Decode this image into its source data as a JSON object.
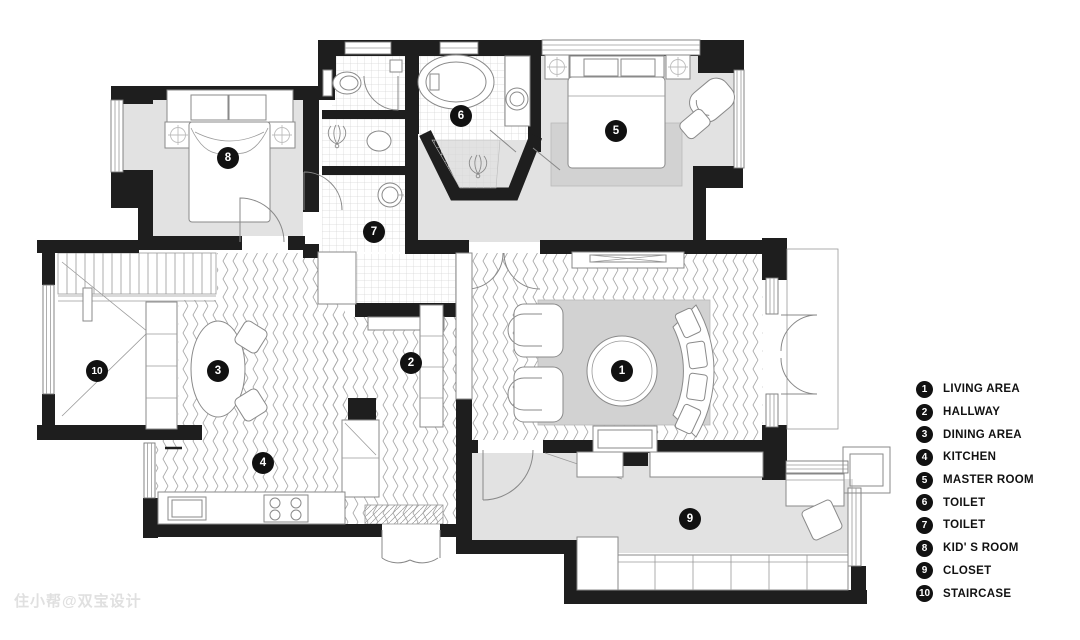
{
  "watermark": {
    "text": "住小帮@双宝设计"
  },
  "legend": {
    "items": [
      {
        "number": "1",
        "label": "LIVING AREA"
      },
      {
        "number": "2",
        "label": "HALLWAY"
      },
      {
        "number": "3",
        "label": "DINING AREA"
      },
      {
        "number": "4",
        "label": "KITCHEN"
      },
      {
        "number": "5",
        "label": "MASTER ROOM"
      },
      {
        "number": "6",
        "label": "TOILET"
      },
      {
        "number": "7",
        "label": "TOILET"
      },
      {
        "number": "8",
        "label": "KID' S ROOM"
      },
      {
        "number": "9",
        "label": "CLOSET"
      },
      {
        "number": "10",
        "label": "STAIRCASE"
      }
    ]
  },
  "plan": {
    "badges": [
      {
        "number": "1",
        "room": "living-area",
        "x": 622,
        "y": 371
      },
      {
        "number": "2",
        "room": "hallway",
        "x": 411,
        "y": 363
      },
      {
        "number": "3",
        "room": "dining-area",
        "x": 218,
        "y": 371
      },
      {
        "number": "4",
        "room": "kitchen",
        "x": 263,
        "y": 463
      },
      {
        "number": "5",
        "room": "master-room",
        "x": 616,
        "y": 131
      },
      {
        "number": "6",
        "room": "toilet-master",
        "x": 461,
        "y": 116
      },
      {
        "number": "7",
        "room": "toilet-hall",
        "x": 374,
        "y": 232
      },
      {
        "number": "8",
        "room": "kids-room",
        "x": 228,
        "y": 158
      },
      {
        "number": "9",
        "room": "closet",
        "x": 690,
        "y": 519
      },
      {
        "number": "10",
        "room": "staircase",
        "x": 97,
        "y": 371
      }
    ],
    "colors": {
      "wall": "#1e1e1e",
      "floor": "#e2e2e2",
      "rug": "#d2d2d2",
      "badge": "#111111",
      "badge_text": "#ffffff"
    }
  }
}
